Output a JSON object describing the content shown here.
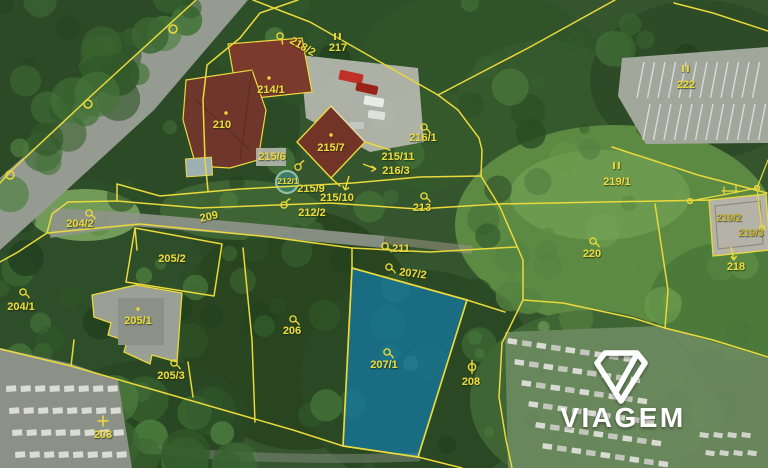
{
  "brand": {
    "name": "VIAGEM"
  },
  "marks": {
    "forest": "II"
  },
  "colors": {
    "boundary_yellow": "#ead93c",
    "highlight_blue": "#0e86c8",
    "watermark_white": "#ffffff"
  },
  "highlight": {
    "parcel": "207/1"
  },
  "parcels": [
    {
      "label": "218/2"
    },
    {
      "label": "217"
    },
    {
      "label": "214/1"
    },
    {
      "label": "210"
    },
    {
      "label": "215/6"
    },
    {
      "label": "215/7"
    },
    {
      "label": "215/11"
    },
    {
      "label": "216/3"
    },
    {
      "label": "216/1"
    },
    {
      "label": "215/9"
    },
    {
      "label": "215/10"
    },
    {
      "label": "212/2"
    },
    {
      "label": "212/1"
    },
    {
      "label": "209"
    },
    {
      "label": "213"
    },
    {
      "label": "211"
    },
    {
      "label": "207/2"
    },
    {
      "label": "204/2"
    },
    {
      "label": "205/2"
    },
    {
      "label": "204/1"
    },
    {
      "label": "205/1"
    },
    {
      "label": "205/3"
    },
    {
      "label": "206"
    },
    {
      "label": "207/1"
    },
    {
      "label": "208"
    },
    {
      "label": "203"
    },
    {
      "label": "220"
    },
    {
      "label": "219/1"
    },
    {
      "label": "222"
    },
    {
      "label": "219/2"
    },
    {
      "label": "219/3"
    },
    {
      "label": "218"
    }
  ]
}
